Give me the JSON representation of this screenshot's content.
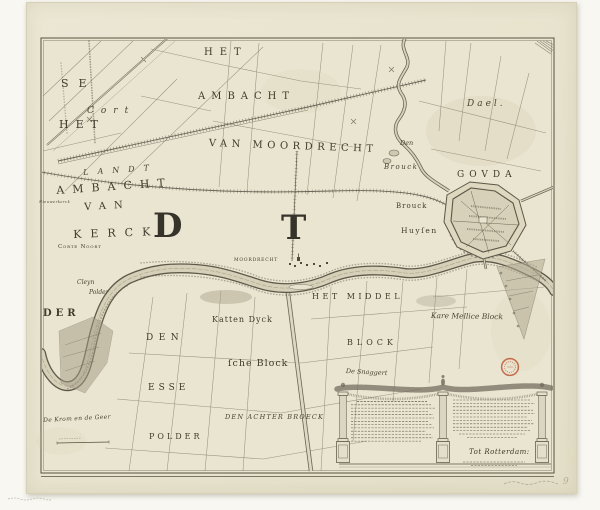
{
  "labels": {
    "het_top": "HET",
    "ambacht_top": "AMBACHT",
    "van_moordrecht": "VAN MOORDRECHT",
    "dael": "Dael.",
    "gouda": "GOVDA",
    "den_broeck_small": "Den",
    "brouck_italic": "Brouck",
    "brouck_upright": "Brouck",
    "huysen": "Huyſen",
    "se": "SE",
    "cort": "Cort",
    "het_left": "HET",
    "landt": "LANDT",
    "ambacht_left": "AMBACHT",
    "nieuwerkerck": "Nieuwerkerck",
    "van_left": "VAN",
    "kerck": "KERCK",
    "letter_d": "D",
    "letter_t": "T",
    "corte_noort": "Corte Noort",
    "cleyn": "Cleyn",
    "polder_small": "Polder",
    "der": "DER",
    "den": "DEN",
    "esse": "ESSE",
    "polder": "POLDER",
    "de_krom_en_de_geer": "De Krom en de Geer",
    "katten_dyck": "Katten Dyck",
    "sche_block": "ſche Block",
    "den_achter_broeck": "DEN ACHTER BROECK",
    "het_middel": "HET MIDDEL",
    "block": "BLOCK",
    "de_snaggert": "De Snaggert",
    "kare_mellice_block": "Kare Mellice Block",
    "moordrecht_village": "MOORDRECHT"
  },
  "cartouche": {
    "imprint": "Tot Rotterdam:"
  },
  "annotations": {
    "pencil_number": "9"
  },
  "colors": {
    "paper": "#e8e4cf",
    "ink": "#57523f",
    "stamp_red": "#bf4e2d"
  }
}
